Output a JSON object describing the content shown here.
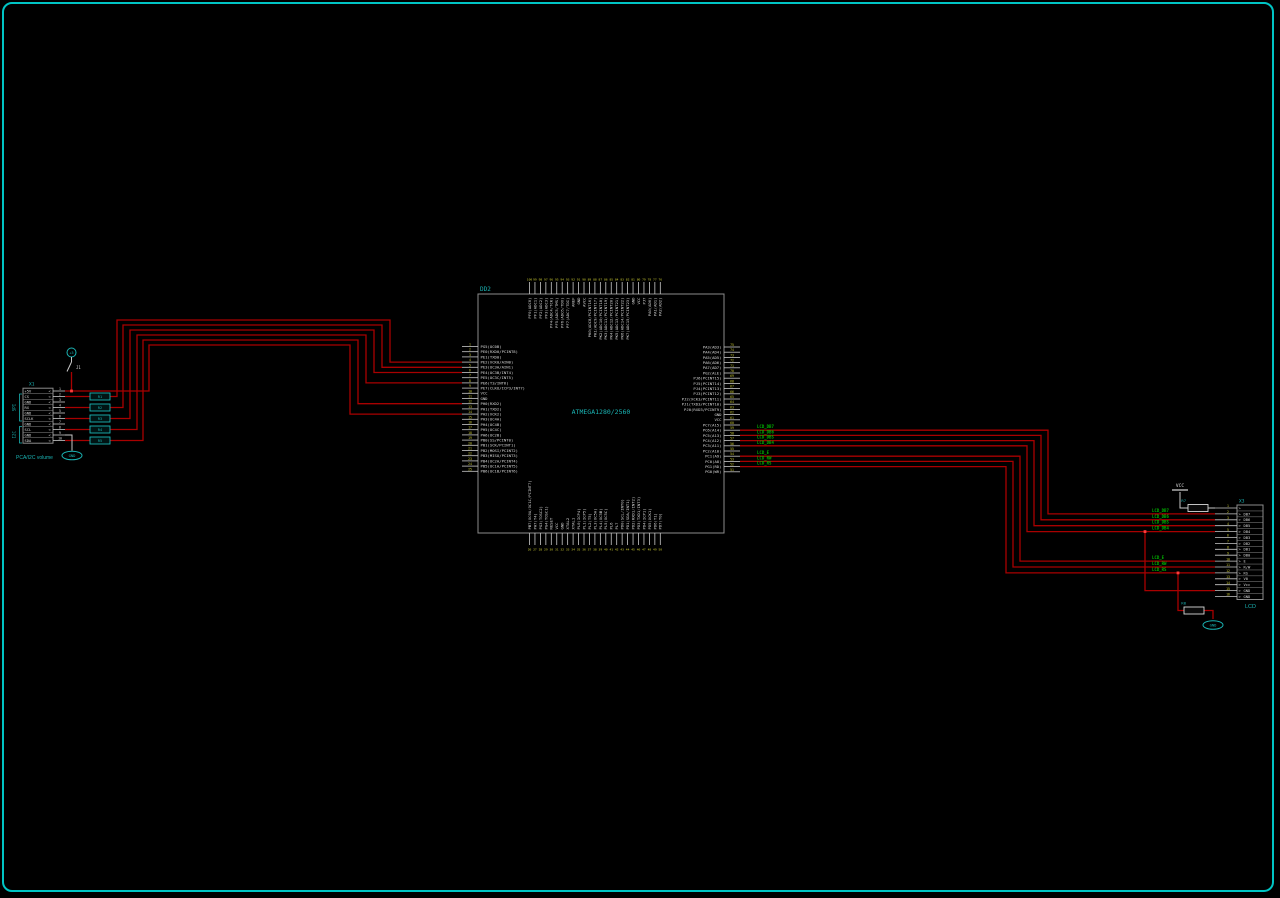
{
  "colors": {
    "bg": "#000000",
    "frame": "#00c4c4",
    "wire": "#a80000",
    "wire_bright": "#ff3c3c",
    "white_wire": "#c8c8c8",
    "pin_label": "#d8d8d8",
    "pin_number": "#c8c832",
    "cyan": "#1ab4b4",
    "green": "#00b400",
    "body_stroke": "#8c8c8c"
  },
  "mcu": {
    "designator": "DD2",
    "part": "ATMEGA1280/2560",
    "box": {
      "x": 478,
      "y": 294,
      "w": 246,
      "h": 239
    },
    "left": {
      "x_stub": 462,
      "x_box": 478,
      "y0": 346.5,
      "pitch": 5.2
    },
    "right": {
      "x_stub": 740,
      "x_box": 724,
      "y0": 347,
      "pitch": 5.2
    },
    "top": {
      "y_stub": 282,
      "y_box": 294,
      "x0": 529.5,
      "pitch": 5.45
    },
    "bottom": {
      "y_stub": 545,
      "y_box": 533,
      "x0": 529.5,
      "pitch": 5.45
    },
    "left_pins": [
      {
        "n": 1,
        "label": "PG5(OC0B)"
      },
      {
        "n": 2,
        "label": "PE0(RXD0/PCINT8)"
      },
      {
        "n": 3,
        "label": "PE1(TXD0)"
      },
      {
        "n": 4,
        "label": "PE2(XCK0/AIN0)"
      },
      {
        "n": 5,
        "label": "PE3(OC3A/AIN1)"
      },
      {
        "n": 6,
        "label": "PE4(OC3B/INT4)"
      },
      {
        "n": 7,
        "label": "PE5(OC3C/INT5)"
      },
      {
        "n": 8,
        "label": "PE6(T3/INT6)"
      },
      {
        "n": 9,
        "label": "PE7(CLKO/ICP3/INT7)"
      },
      {
        "n": 10,
        "label": "VCC"
      },
      {
        "n": 11,
        "label": "GND"
      },
      {
        "n": 12,
        "label": "PH0(RXD2)"
      },
      {
        "n": 13,
        "label": "PH1(TXD2)"
      },
      {
        "n": 14,
        "label": "PH2(XCK2)"
      },
      {
        "n": 15,
        "label": "PH3(OC4A)"
      },
      {
        "n": 16,
        "label": "PH4(OC4B)"
      },
      {
        "n": 17,
        "label": "PH5(OC4C)"
      },
      {
        "n": 18,
        "label": "PH6(OC2B)"
      },
      {
        "n": 19,
        "label": "PB0(SS/PCINT0)"
      },
      {
        "n": 20,
        "label": "PB1(SCK/PCINT1)"
      },
      {
        "n": 21,
        "label": "PB2(MOSI/PCINT2)"
      },
      {
        "n": 22,
        "label": "PB3(MISO/PCINT3)"
      },
      {
        "n": 23,
        "label": "PB4(OC2A/PCINT4)"
      },
      {
        "n": 24,
        "label": "PB5(OC1A/PCINT5)"
      },
      {
        "n": 25,
        "label": "PB6(OC1B/PCINT6)"
      }
    ],
    "right_pins": [
      {
        "n": 75,
        "label": "PA3(AD3)"
      },
      {
        "n": 74,
        "label": "PA4(AD4)"
      },
      {
        "n": 73,
        "label": "PA5(AD5)"
      },
      {
        "n": 72,
        "label": "PA6(AD6)"
      },
      {
        "n": 71,
        "label": "PA7(AD7)"
      },
      {
        "n": 70,
        "label": "PG2(ALE)"
      },
      {
        "n": 69,
        "label": "PJ6(PCINT15)"
      },
      {
        "n": 68,
        "label": "PJ5(PCINT14)"
      },
      {
        "n": 67,
        "label": "PJ4(PCINT13)"
      },
      {
        "n": 66,
        "label": "PJ3(PCINT12)"
      },
      {
        "n": 65,
        "label": "PJ2(XCK3/PCINT11)"
      },
      {
        "n": 64,
        "label": "PJ1(TXD3/PCINT10)"
      },
      {
        "n": 63,
        "label": "PJ0(RXD3/PCINT9)"
      },
      {
        "n": 62,
        "label": "GND"
      },
      {
        "n": 61,
        "label": "VCC"
      },
      {
        "n": 60,
        "label": "PC7(A15)"
      },
      {
        "n": 59,
        "label": "PC6(A14)"
      },
      {
        "n": 58,
        "label": "PC5(A13)"
      },
      {
        "n": 57,
        "label": "PC4(A12)"
      },
      {
        "n": 56,
        "label": "PC3(A11)"
      },
      {
        "n": 55,
        "label": "PC2(A10)"
      },
      {
        "n": 54,
        "label": "PC1(A9)"
      },
      {
        "n": 53,
        "label": "PC0(A8)"
      },
      {
        "n": 52,
        "label": "PG1(RD)"
      },
      {
        "n": 51,
        "label": "PG0(WR)"
      }
    ],
    "top_pins": [
      {
        "n": 100,
        "label": "PF0(ADC0)"
      },
      {
        "n": 99,
        "label": "PF1(ADC1)"
      },
      {
        "n": 98,
        "label": "PF2(ADC2)"
      },
      {
        "n": 97,
        "label": "PF3(ADC3)"
      },
      {
        "n": 96,
        "label": "PF4(ADC4/TCK)"
      },
      {
        "n": 95,
        "label": "PF5(ADC5/TMS)"
      },
      {
        "n": 94,
        "label": "PF6(ADC6/TDO)"
      },
      {
        "n": 93,
        "label": "PF7(ADC7/TDI)"
      },
      {
        "n": 92,
        "label": "AREF"
      },
      {
        "n": 91,
        "label": "GND"
      },
      {
        "n": 90,
        "label": "AVCC"
      },
      {
        "n": 89,
        "label": "PK0(ADC8/PCINT16)"
      },
      {
        "n": 88,
        "label": "PK1(ADC9/PCINT17)"
      },
      {
        "n": 87,
        "label": "PK2(ADC10/PCINT18)"
      },
      {
        "n": 86,
        "label": "PK3(ADC11/PCINT19)"
      },
      {
        "n": 85,
        "label": "PK4(ADC12/PCINT20)"
      },
      {
        "n": 84,
        "label": "PK5(ADC13/PCINT21)"
      },
      {
        "n": 83,
        "label": "PK6(ADC14/PCINT22)"
      },
      {
        "n": 82,
        "label": "PK7(ADC15/PCINT23)"
      },
      {
        "n": 81,
        "label": "GND"
      },
      {
        "n": 80,
        "label": "VCC"
      },
      {
        "n": 79,
        "label": "PJ7"
      },
      {
        "n": 78,
        "label": "PA0(AD0)"
      },
      {
        "n": 77,
        "label": "PA1(AD1)"
      },
      {
        "n": 76,
        "label": "PA2(AD2)"
      }
    ],
    "bottom_pins": [
      {
        "n": 26,
        "label": "PB7(OC0A/OC1C/PCINT7)"
      },
      {
        "n": 27,
        "label": "PH7(T4)"
      },
      {
        "n": 28,
        "label": "PG3(TOSC2)"
      },
      {
        "n": 29,
        "label": "PG4(TOSC1)"
      },
      {
        "n": 30,
        "label": "RESET"
      },
      {
        "n": 31,
        "label": "VCC"
      },
      {
        "n": 32,
        "label": "GND"
      },
      {
        "n": 33,
        "label": "XTAL2"
      },
      {
        "n": 34,
        "label": "XTAL1"
      },
      {
        "n": 35,
        "label": "PL0(ICP4)"
      },
      {
        "n": 36,
        "label": "PL1(ICP5)"
      },
      {
        "n": 37,
        "label": "PL2(T5)"
      },
      {
        "n": 38,
        "label": "PL3(OC5A)"
      },
      {
        "n": 39,
        "label": "PL4(OC5B)"
      },
      {
        "n": 40,
        "label": "PL5(OC5C)"
      },
      {
        "n": 41,
        "label": "PL6"
      },
      {
        "n": 42,
        "label": "PL7"
      },
      {
        "n": 43,
        "label": "PD0(SCL/INT0)"
      },
      {
        "n": 44,
        "label": "PD1(SDA/INT1)"
      },
      {
        "n": 45,
        "label": "PD2(RXD1/INT2)"
      },
      {
        "n": 46,
        "label": "PD3(TXD1/INT3)"
      },
      {
        "n": 47,
        "label": "PD4(ICP1)"
      },
      {
        "n": 48,
        "label": "PD5(XCK1)"
      },
      {
        "n": 49,
        "label": "PD6(T1)"
      },
      {
        "n": 50,
        "label": "PD7(T0)"
      }
    ]
  },
  "left_connector": {
    "designator": "X1",
    "caption": "PCA/I2C volume",
    "box": {
      "x": 23,
      "y": 388.2,
      "w": 30,
      "h": 55
    },
    "y0": 391,
    "pitch": 5.5,
    "x_stub_end": 65,
    "pins": [
      {
        "n": 1,
        "label": "+5V"
      },
      {
        "n": 2,
        "label": "CS"
      },
      {
        "n": 3,
        "label": "GND"
      },
      {
        "n": 4,
        "label": "RX"
      },
      {
        "n": 5,
        "label": "GND"
      },
      {
        "n": 6,
        "label": "SCLK"
      },
      {
        "n": 7,
        "label": "GND"
      },
      {
        "n": 8,
        "label": "SCL"
      },
      {
        "n": 9,
        "label": "GND"
      },
      {
        "n": 10,
        "label": "SDA"
      }
    ],
    "groups": [
      {
        "label": "SPI",
        "y1": 394,
        "y2": 421
      },
      {
        "label": "I2C",
        "y1": 426.5,
        "y2": 443
      }
    ],
    "jumper_label": "J1",
    "power_node_label": "+5",
    "gnd_label": "GND"
  },
  "series_parts": {
    "x": 90,
    "w": 20,
    "h": 7,
    "items": [
      {
        "label": "R1",
        "y": 396.5
      },
      {
        "label": "R2",
        "y": 407.5
      },
      {
        "label": "R3",
        "y": 418.5
      },
      {
        "label": "R4",
        "y": 429.5
      },
      {
        "label": "R5",
        "y": 440.5
      }
    ]
  },
  "lcd": {
    "designator": "X3",
    "caption": "LCD",
    "box": {
      "x": 1237,
      "y": 505,
      "w": 26,
      "h": 94.5
    },
    "y0": 508,
    "pitch": 5.9,
    "x_stub_start": 1215,
    "pins": [
      {
        "n": 1,
        "label": ""
      },
      {
        "n": 2,
        "label": "DB7"
      },
      {
        "n": 3,
        "label": "DB6"
      },
      {
        "n": 4,
        "label": "DB5"
      },
      {
        "n": 5,
        "label": "DB4"
      },
      {
        "n": 6,
        "label": "DB3"
      },
      {
        "n": 7,
        "label": "DB2"
      },
      {
        "n": 8,
        "label": "DB1"
      },
      {
        "n": 9,
        "label": "DB0"
      },
      {
        "n": 10,
        "label": "E"
      },
      {
        "n": 11,
        "label": "R/W"
      },
      {
        "n": 12,
        "label": "RS"
      },
      {
        "n": 13,
        "label": "V0"
      },
      {
        "n": 14,
        "label": "Vcc"
      },
      {
        "n": 15,
        "label": "GND"
      },
      {
        "n": 16,
        "label": "GND"
      }
    ],
    "vcc_label": "VCC",
    "gnd_label": "GND",
    "r7_label": "R7",
    "r8_label": "R8"
  },
  "net_labels": {
    "near_mcu": [
      {
        "text": "LCD_DB7",
        "x": 757,
        "y": 428.2
      },
      {
        "text": "LCD_DB6",
        "x": 757,
        "y": 433.4
      },
      {
        "text": "LCD_DB5",
        "x": 757,
        "y": 438.6
      },
      {
        "text": "LCD_DB4",
        "x": 757,
        "y": 443.8
      },
      {
        "text": "LCD_E",
        "x": 757,
        "y": 454.2
      },
      {
        "text": "LCD_RW",
        "x": 757,
        "y": 459.4
      },
      {
        "text": "LCD_RS",
        "x": 757,
        "y": 464.6
      }
    ],
    "near_lcd": [
      {
        "text": "LCD_DB7",
        "x": 1152,
        "y": 511.9
      },
      {
        "text": "LCD_DB6",
        "x": 1152,
        "y": 517.8
      },
      {
        "text": "LCD_DB5",
        "x": 1152,
        "y": 523.7
      },
      {
        "text": "LCD_DB4",
        "x": 1152,
        "y": 529.6
      },
      {
        "text": "LCD_E",
        "x": 1152,
        "y": 559.1
      },
      {
        "text": "LCD_RW",
        "x": 1152,
        "y": 565.0
      },
      {
        "text": "LCD_RS",
        "x": 1152,
        "y": 570.9
      }
    ]
  },
  "wires": {
    "red": [
      [
        [
          65,
          396.5
        ],
        [
          90,
          396.5
        ]
      ],
      [
        [
          110,
          396.5
        ],
        [
          117,
          396.5
        ],
        [
          117,
          320
        ],
        [
          390,
          320
        ],
        [
          390,
          362.1
        ],
        [
          462,
          362.1
        ]
      ],
      [
        [
          65,
          407.5
        ],
        [
          90,
          407.5
        ]
      ],
      [
        [
          110,
          407.5
        ],
        [
          123,
          407.5
        ],
        [
          123,
          325
        ],
        [
          382,
          325
        ],
        [
          382,
          367.3
        ],
        [
          462,
          367.3
        ]
      ],
      [
        [
          65,
          418.5
        ],
        [
          90,
          418.5
        ]
      ],
      [
        [
          110,
          418.5
        ],
        [
          130,
          418.5
        ],
        [
          130,
          330
        ],
        [
          374,
          330
        ],
        [
          374,
          372.5
        ],
        [
          462,
          372.5
        ]
      ],
      [
        [
          65,
          429.5
        ],
        [
          90,
          429.5
        ]
      ],
      [
        [
          110,
          429.5
        ],
        [
          137,
          429.5
        ],
        [
          137,
          335
        ],
        [
          366,
          335
        ],
        [
          366,
          382.9
        ],
        [
          462,
          382.9
        ]
      ],
      [
        [
          65,
          440.5
        ],
        [
          90,
          440.5
        ]
      ],
      [
        [
          110,
          440.5
        ],
        [
          143,
          440.5
        ],
        [
          143,
          340
        ],
        [
          358,
          340
        ],
        [
          358,
          403.7
        ],
        [
          462,
          403.7
        ]
      ],
      [
        [
          71.5,
          372
        ],
        [
          71.5,
          391
        ],
        [
          65,
          391
        ]
      ],
      [
        [
          71.5,
          391
        ],
        [
          149,
          391
        ],
        [
          149,
          345
        ],
        [
          350,
          345
        ],
        [
          350,
          414.1
        ],
        [
          462,
          414.1
        ]
      ],
      [
        [
          740,
          430.2
        ],
        [
          1048,
          430.2
        ],
        [
          1048,
          513.9
        ],
        [
          1215,
          513.9
        ]
      ],
      [
        [
          740,
          435.4
        ],
        [
          1041,
          435.4
        ],
        [
          1041,
          519.8
        ],
        [
          1215,
          519.8
        ]
      ],
      [
        [
          740,
          440.6
        ],
        [
          1034,
          440.6
        ],
        [
          1034,
          525.7
        ],
        [
          1215,
          525.7
        ]
      ],
      [
        [
          740,
          445.8
        ],
        [
          1027,
          445.8
        ],
        [
          1027,
          531.6
        ],
        [
          1215,
          531.6
        ]
      ],
      [
        [
          740,
          456.2
        ],
        [
          1020,
          456.2
        ],
        [
          1020,
          561.1
        ],
        [
          1215,
          561.1
        ]
      ],
      [
        [
          740,
          461.4
        ],
        [
          1013,
          461.4
        ],
        [
          1013,
          567
        ],
        [
          1215,
          567
        ]
      ],
      [
        [
          740,
          466.6
        ],
        [
          1006,
          466.6
        ],
        [
          1006,
          572.9
        ],
        [
          1215,
          572.9
        ]
      ],
      [
        [
          1145,
          531.6
        ],
        [
          1145,
          590.6
        ],
        [
          1215,
          590.6
        ]
      ],
      [
        [
          1178,
          572.9
        ],
        [
          1178,
          610.5
        ],
        [
          1184,
          610.5
        ]
      ],
      [
        [
          1204,
          610.5
        ],
        [
          1213,
          610.5
        ],
        [
          1213,
          619
        ]
      ]
    ],
    "white": [
      [
        [
          65,
          435
        ],
        [
          72,
          435
        ],
        [
          72,
          450.8
        ]
      ],
      [
        [
          1180,
          492
        ],
        [
          1180,
          508
        ],
        [
          1188,
          508
        ]
      ],
      [
        [
          1208,
          508
        ],
        [
          1215,
          508
        ]
      ]
    ],
    "junctions": [
      [
        71.5,
        391
      ],
      [
        1145,
        531.6
      ],
      [
        1178,
        572.9
      ]
    ]
  },
  "resistors": [
    {
      "label": "R7",
      "x": 1188,
      "y": 504.5,
      "w": 20,
      "h": 7,
      "lx": 1186,
      "ly": 502
    },
    {
      "label": "R8",
      "x": 1184,
      "y": 607,
      "w": 20,
      "h": 7,
      "lx": 1186,
      "ly": 604.5
    }
  ],
  "power_symbols": {
    "vcc": {
      "text": "VCC",
      "x": 1180,
      "y": 487,
      "bar": [
        1172,
        490,
        1188,
        490
      ]
    },
    "gnd_left": {
      "text": "GND",
      "cx": 72,
      "cy": 455.5
    },
    "gnd_right": {
      "text": "GND",
      "cx": 1213,
      "cy": 625
    },
    "plus5": {
      "text": "+5",
      "cx": 71.5,
      "cy": 352.5
    }
  }
}
